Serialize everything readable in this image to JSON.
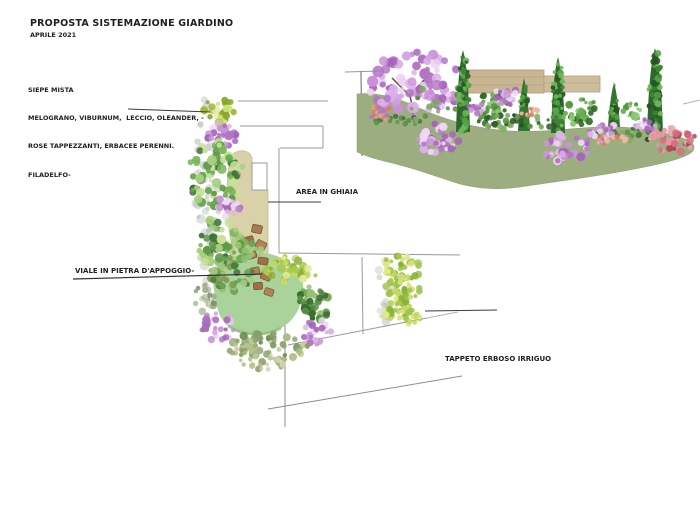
{
  "header": {
    "title": "PROPOSTA SISTEMAZIONE GIARDINO",
    "subtitle": "APRILE 2021"
  },
  "labels": {
    "siepe_lines": [
      "SIEPE MISTA",
      "MELOGRANO, VIBURNUM,  LECCIO, OLEANDER, -",
      "ROSE TAPPEZZANTI, ERBACEE PERENNI.",
      "FILADELFO-"
    ],
    "area_ghiaia": "AREA IN GHIAIA",
    "viale": "VIALE IN PIETRA D'APPOGGIO-",
    "tappeto": "TAPPETO ERBOSO IRRIGUO"
  },
  "palette": {
    "text": "#1f1f1f",
    "boundary_line_gray": "#999999",
    "callout_line_dark": "#3c3c3c",
    "plan_lawn_green": "#a9d39b",
    "elevation_lawn_sage": "#9cad7f",
    "gravel_tan": "#d9d2a8",
    "wall_tan": "#c8b693",
    "stepping_stone_brown": "#a87a4e",
    "flower_purple": "#c897d6",
    "flower_salmon": "#e59d8b",
    "rose_pink": "#d67083",
    "foliage_green": "#5d9a48",
    "foliage_yellow_green": "#c3d95e",
    "cypress_dark_green": "#2e672c"
  }
}
